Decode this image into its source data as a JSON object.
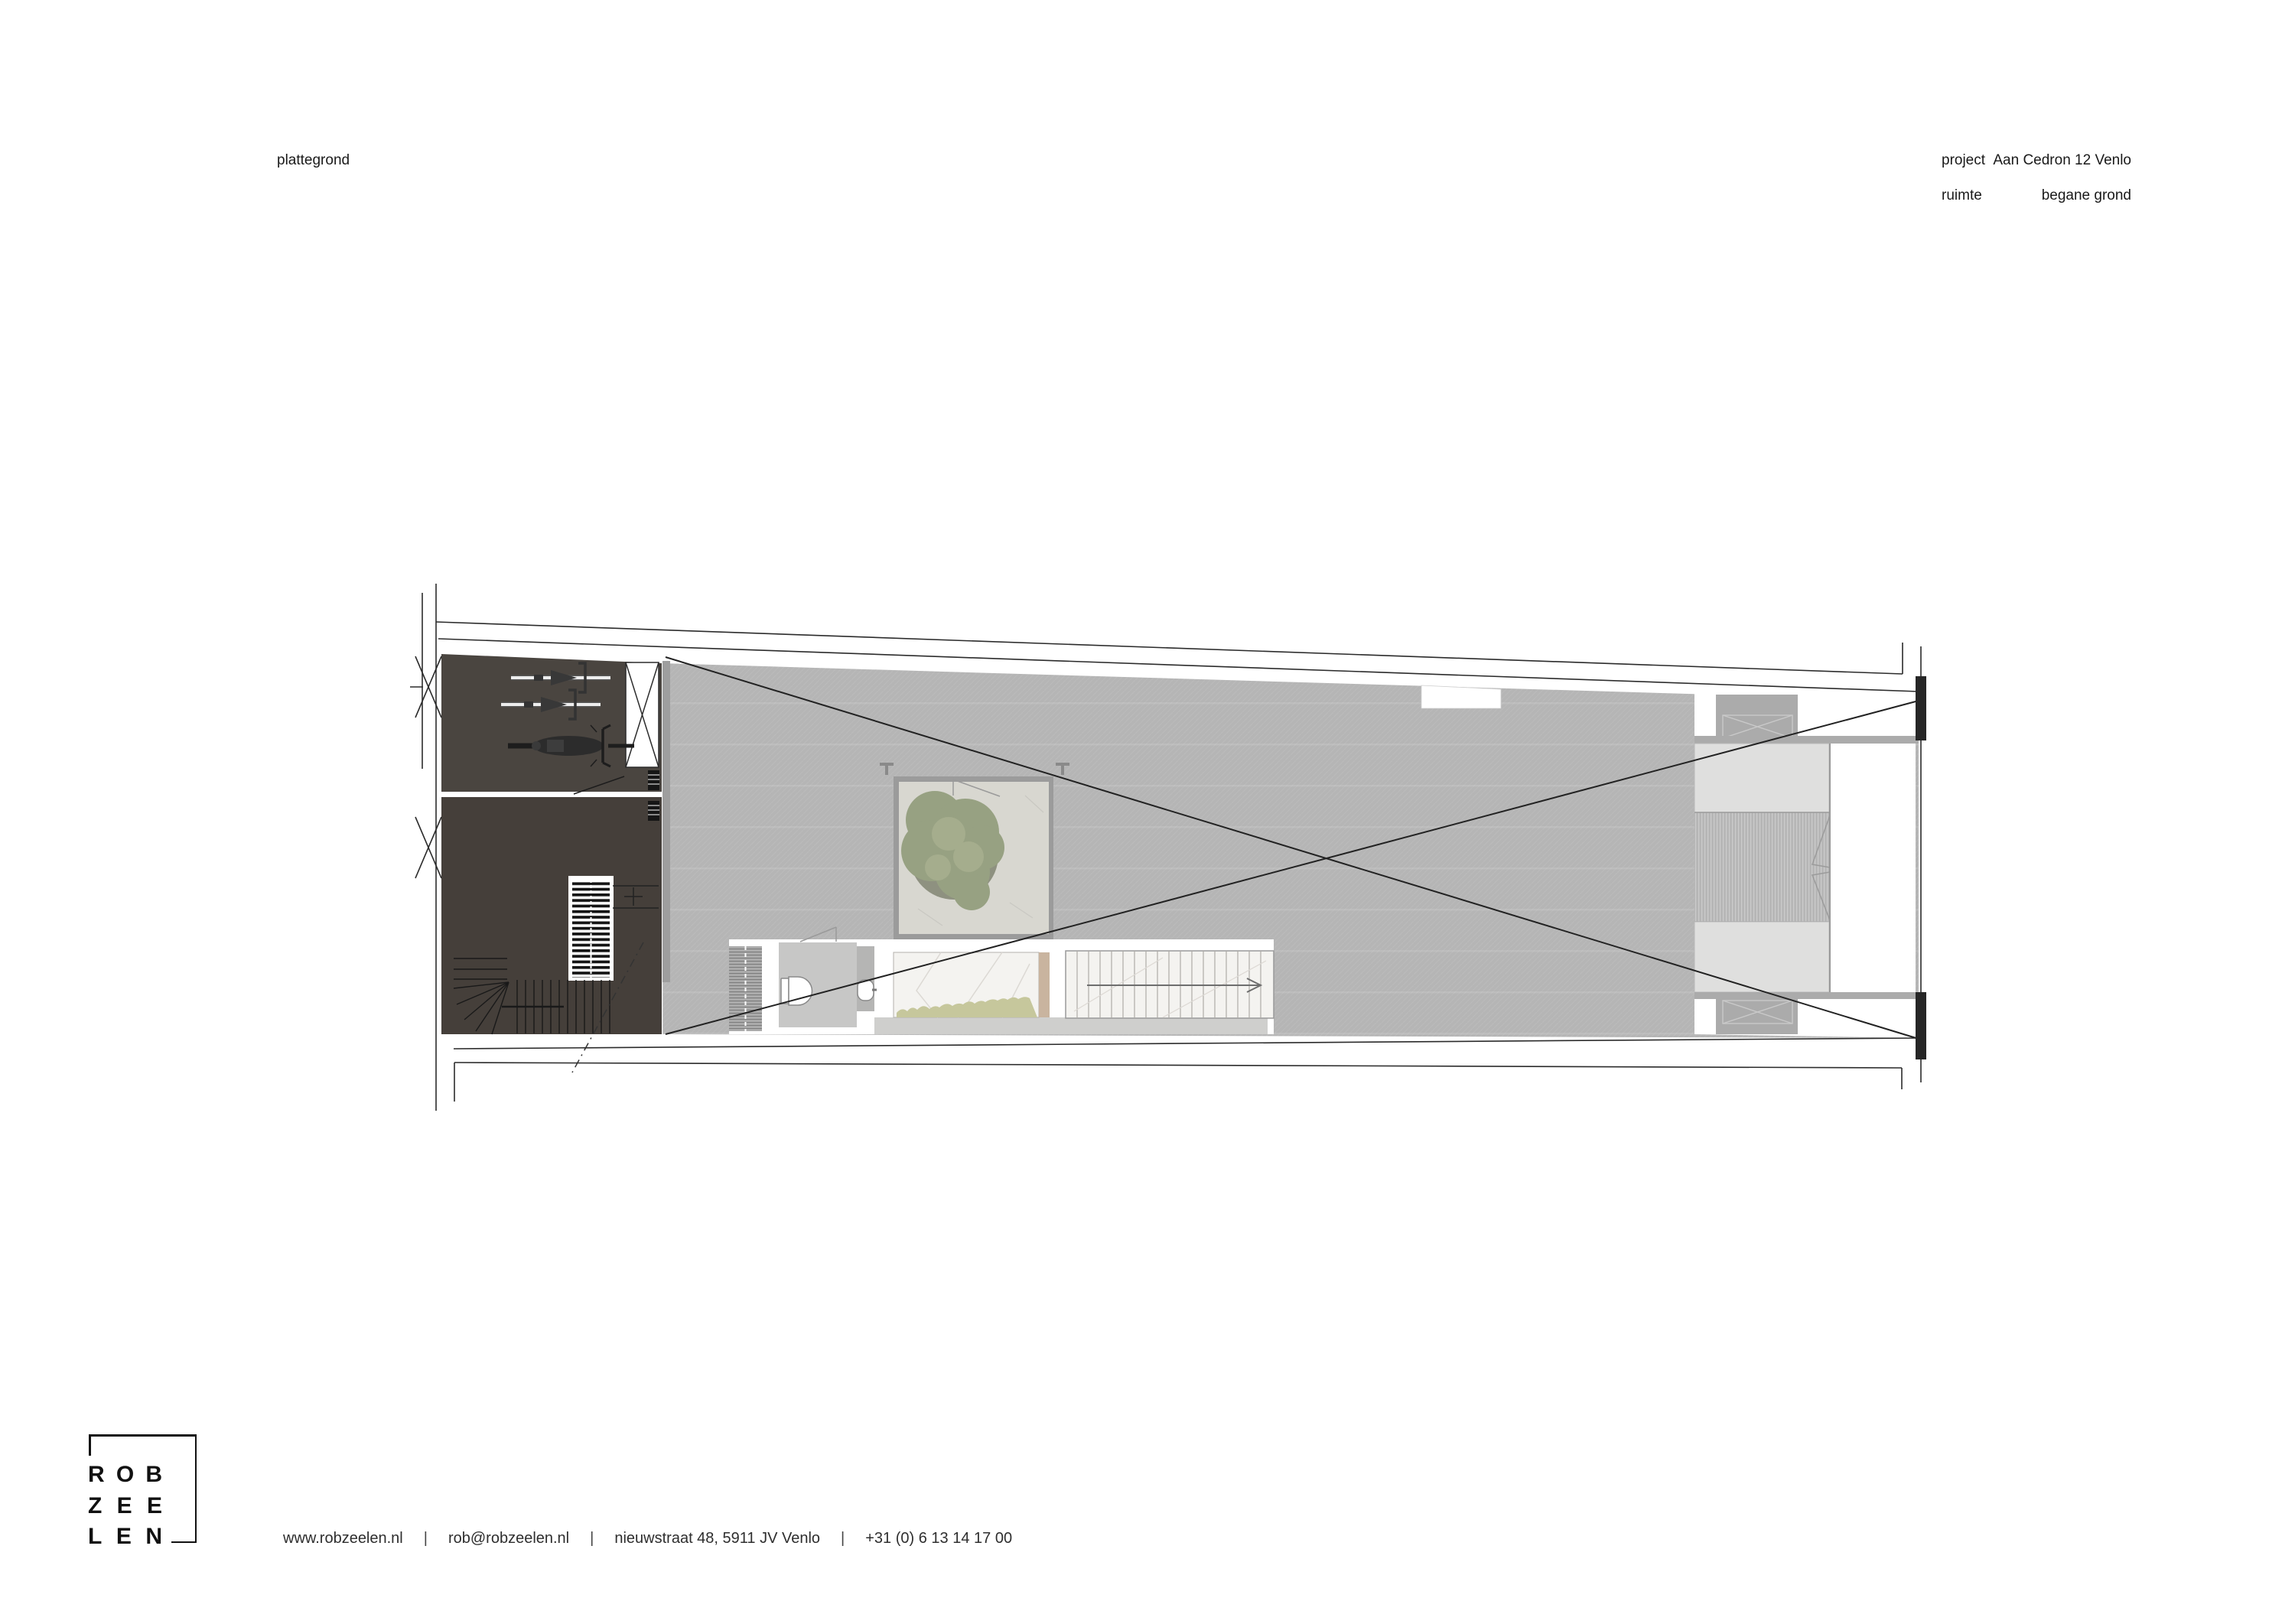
{
  "header": {
    "drawing_type_label": "plattegrond"
  },
  "title_block": {
    "project_label": "project",
    "project_value": "Aan Cedron 12  Venlo",
    "room_label": "ruimte",
    "room_value": "begane grond"
  },
  "logo": {
    "rows": [
      [
        "R",
        "O",
        "B"
      ],
      [
        "Z",
        "E",
        "E"
      ],
      [
        "L",
        "E",
        "N"
      ]
    ]
  },
  "footer": {
    "website": "www.robzeelen.nl",
    "separator": "|",
    "email": "rob@robzeelen.nl",
    "address": "nieuwstraat 48, 5911 JV Venlo",
    "phone": "+31  (0) 6 13 14 17 00"
  },
  "colors": {
    "floor-gray": "#b5b5b5",
    "dark1": "#4a4540",
    "dark2": "#453f3a",
    "patio": "#d8d7d0",
    "marble": "#f4f3f0",
    "panel": "#dfdfde",
    "wall-gray": "#ababab",
    "greenery": "#c6c79c",
    "tan": "#c9b49f",
    "tree-green": "#97a182",
    "pier": "#262626",
    "line": "#222222"
  }
}
